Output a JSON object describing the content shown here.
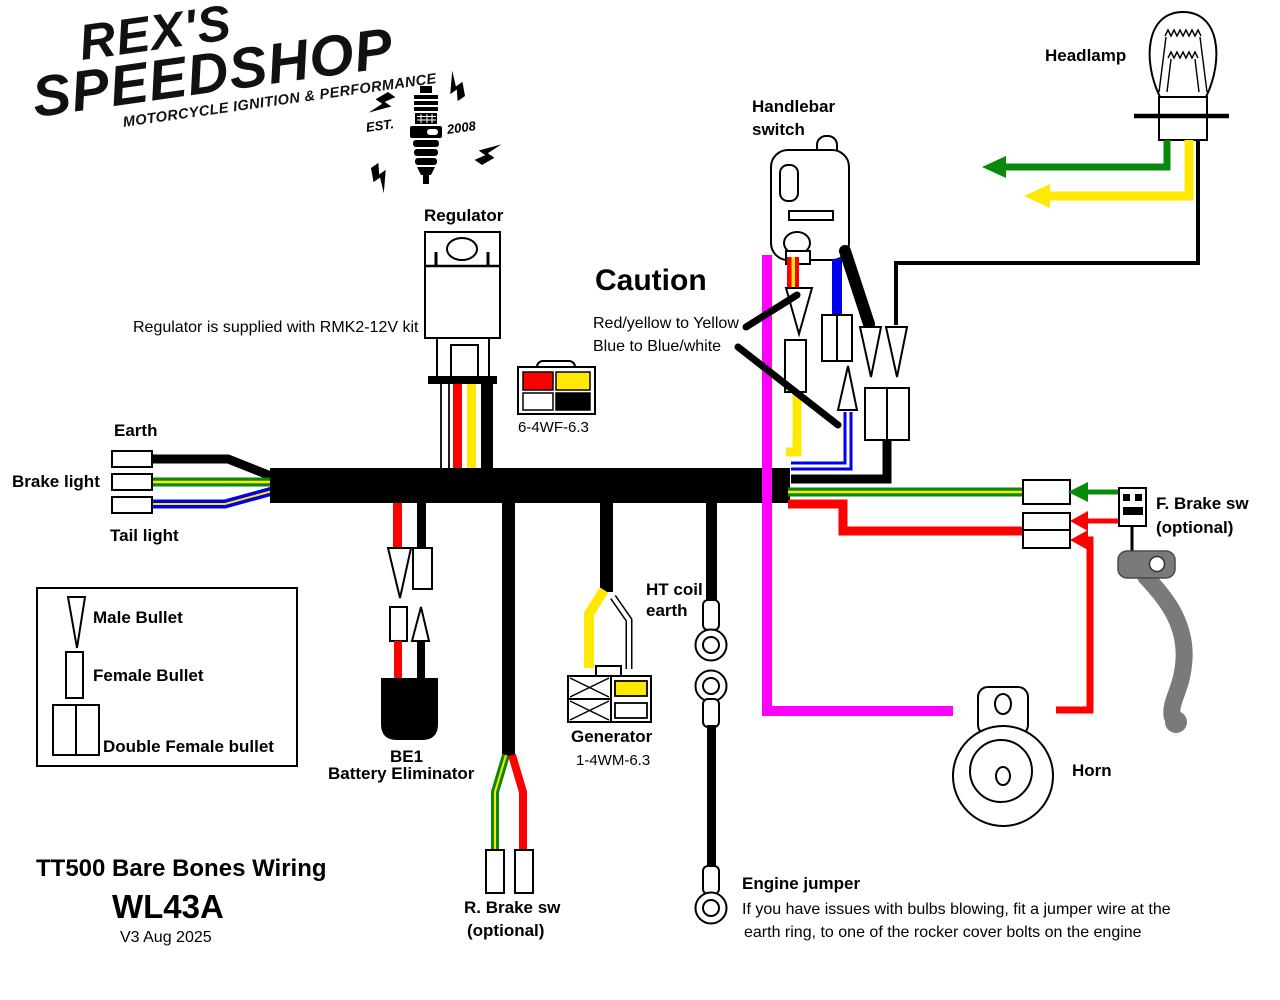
{
  "logo": {
    "line1": "REX'S",
    "line2": "SPEEDSHOP",
    "tagline": "MOTORCYCLE IGNITION & PERFORMANCE",
    "est": "EST.",
    "year": "2008"
  },
  "title_block": {
    "title": "TT500 Bare Bones Wiring",
    "code": "WL43A",
    "version": "V3 Aug 2025"
  },
  "caution": {
    "title": "Caution",
    "line1": "Red/yellow to Yellow",
    "line2": "Blue to Blue/white"
  },
  "legend": {
    "male": "Male Bullet",
    "female": "Female Bullet",
    "double_female": "Double Female bullet"
  },
  "labels": {
    "headlamp": "Headlamp",
    "handlebar_switch_line1": "Handlebar",
    "handlebar_switch_line2": "switch",
    "regulator": "Regulator",
    "regulator_note": "Regulator is supplied with RMK2-12V kit",
    "connector_6_4wf": "6-4WF-6.3",
    "earth": "Earth",
    "brake_light": "Brake light",
    "tail_light": "Tail light",
    "be1_line1": "BE1",
    "be1_line2": "Battery Eliminator",
    "r_brake_line1": "R. Brake sw",
    "r_brake_line2": "(optional)",
    "generator": "Generator",
    "connector_1_4wm": "1-4WM-6.3",
    "ht_coil_line1": "HT coil",
    "ht_coil_line2": "earth",
    "f_brake_line1": "F. Brake sw",
    "f_brake_line2": "(optional)",
    "horn": "Horn",
    "engine_jumper": "Engine jumper",
    "engine_jumper_note1": "If you have issues with bulbs blowing, fit a jumper wire at the",
    "engine_jumper_note2": "earth ring, to one of the rocker cover bolts on the engine"
  },
  "colors": {
    "black": "#000000",
    "red": "#FF0000",
    "yellow": "#FFE900",
    "blue": "#0000EE",
    "magenta": "#FF00FF",
    "green": "#0A8A0A",
    "gray": "#7A7A7A"
  }
}
